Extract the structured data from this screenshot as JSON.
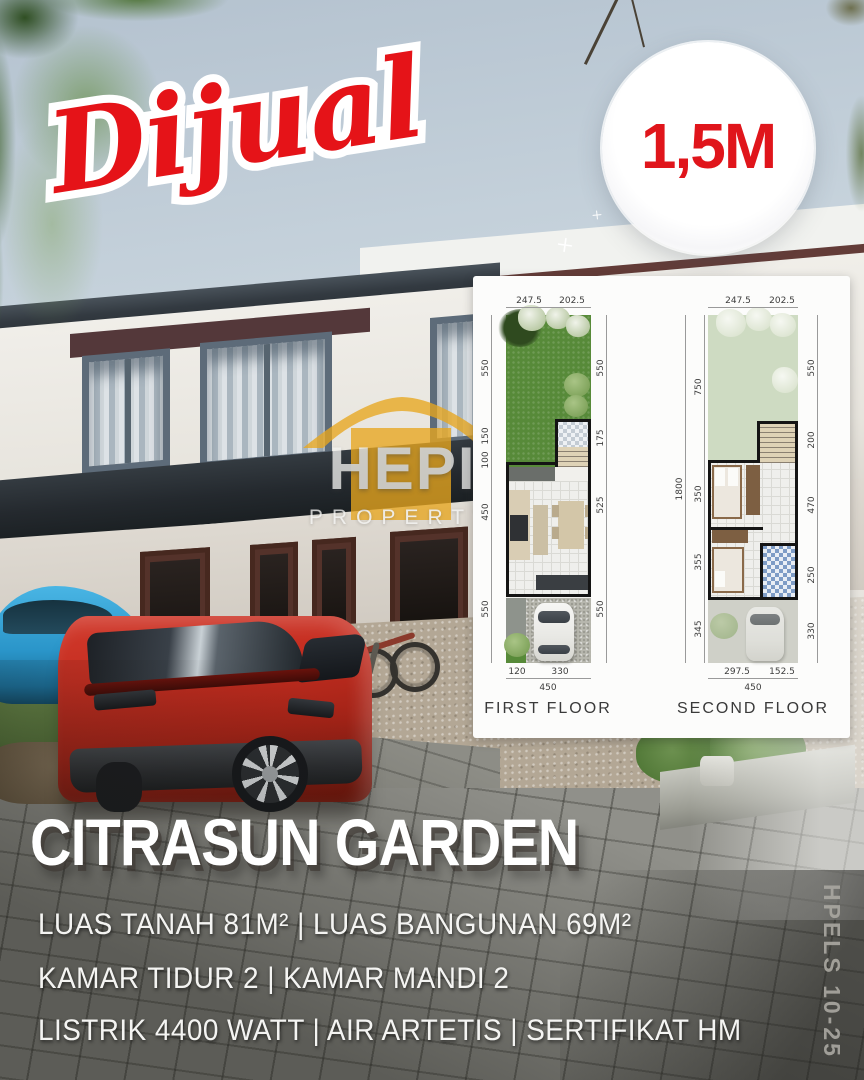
{
  "overlay": {
    "sale_label": "Dijual",
    "price_badge": "1,5M"
  },
  "watermark": {
    "name": "HEPI",
    "subtitle": "PROPERTY"
  },
  "floorplans": {
    "first": {
      "label": "FIRST FLOOR",
      "dims_top": [
        "247.5",
        "202.5"
      ],
      "dims_left": [
        "550",
        "150",
        "100",
        "450",
        "550"
      ],
      "dims_right": [
        "550",
        "175",
        "525",
        "550"
      ],
      "dims_bottom": [
        "120",
        "330"
      ],
      "dim_total_bottom": "450"
    },
    "second": {
      "label": "SECOND FLOOR",
      "dims_top": [
        "247.5",
        "202.5"
      ],
      "dim_total_left": "1800",
      "dims_left": [
        "750",
        "350",
        "355",
        "345"
      ],
      "dims_right": [
        "550",
        "200",
        "470",
        "250",
        "330"
      ],
      "dims_bottom": [
        "297.5",
        "152.5"
      ],
      "dim_total_bottom": "450"
    }
  },
  "listing": {
    "title": "CITRASUN GARDEN",
    "details": [
      "LUAS TANAH 81M² | LUAS BANGUNAN 69M²",
      "KAMAR TIDUR 2 | KAMAR MANDI 2",
      "LISTRIK 4400 WATT | AIR ARTETIS | SERTIFIKAT HM"
    ],
    "watermark_code": "HPELS 10-25"
  },
  "colors": {
    "accent_red": "#e0151b",
    "watermark_gold": "#e8a61f",
    "plan_green": "#578a39",
    "plan_green_pale": "#cedbc2",
    "badge_bg": "#ffffff"
  }
}
